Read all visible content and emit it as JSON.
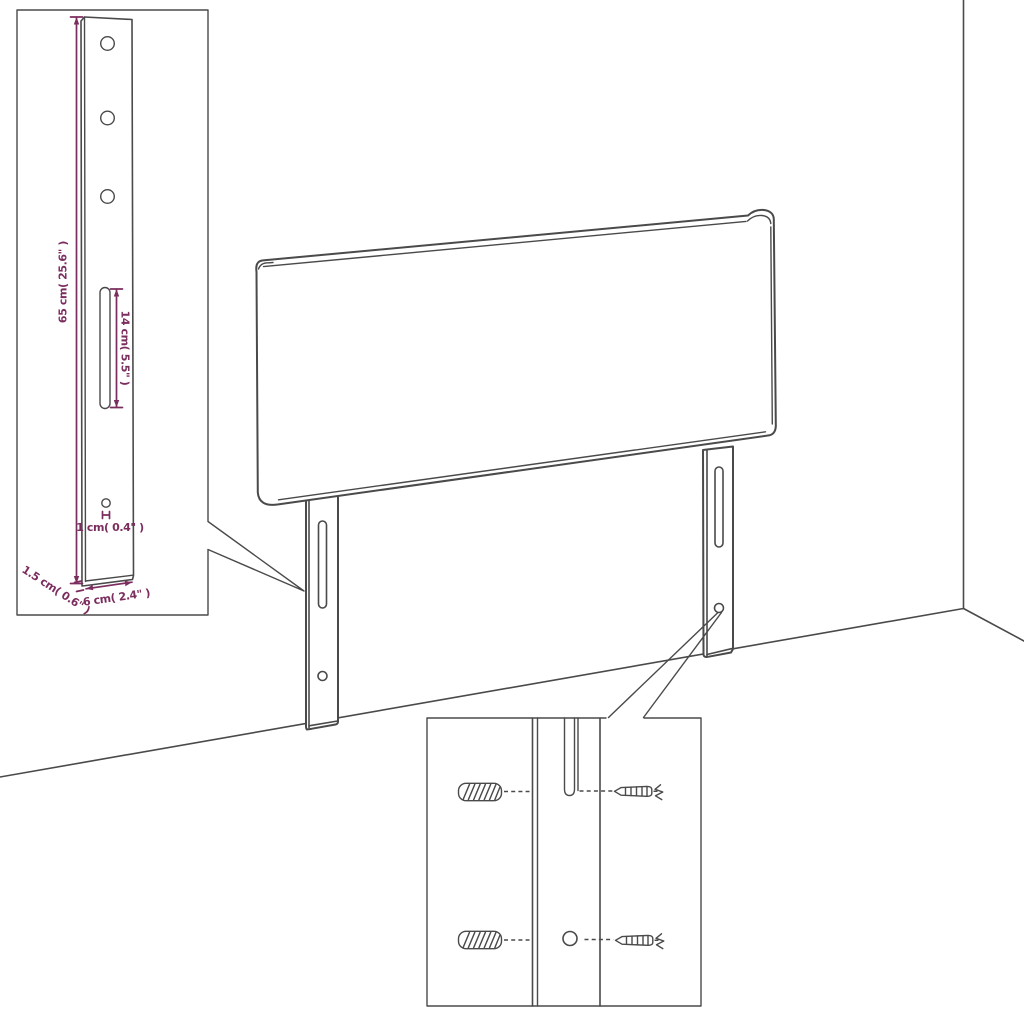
{
  "colors": {
    "background": "#ffffff",
    "line": "#4a4a4a",
    "dimension": "#7b2d5e"
  },
  "leg_detail_inset": {
    "dim_height": "65 cm( 25.6\" )",
    "dim_slot": "14 cm( 5.5\" )",
    "dim_hole": "1 cm( 0.4\" )",
    "dim_thickness": "1.5 cm( 0.6\" )",
    "dim_width": "6 cm( 2.4\" )",
    "features": [
      "screw-hole-top",
      "screw-hole-middle",
      "screw-hole-bottom",
      "height-adjustment-slot",
      "pin-hole"
    ]
  },
  "mounting_detail_inset": {
    "parts": [
      "wall-plug-upper",
      "wall-plug-lower",
      "screw-upper",
      "screw-lower",
      "leg-slot",
      "leg-hole"
    ]
  },
  "main_drawing": {
    "parts": [
      "headboard-panel",
      "left-leg",
      "right-leg",
      "wall-corner",
      "floor-line"
    ]
  }
}
